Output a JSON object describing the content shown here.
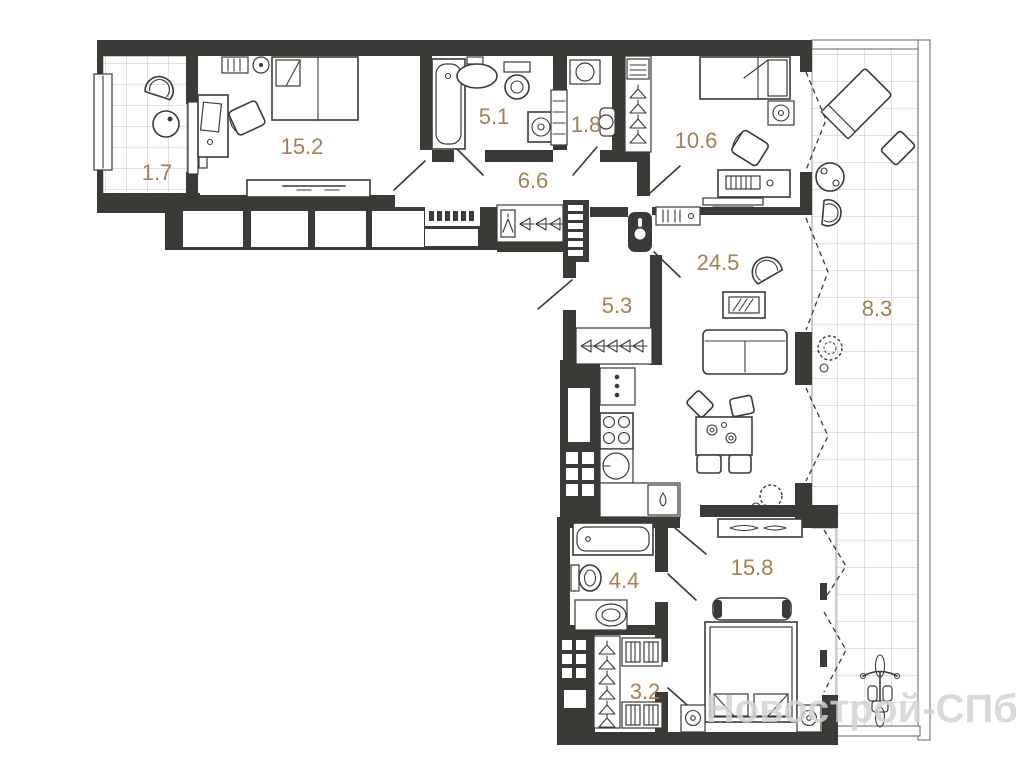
{
  "plan": {
    "type": "apartment-floor-plan",
    "colors": {
      "wall": "#3c3a37",
      "area_label": "#a5814d",
      "tile_grid": "#c3c3c3",
      "watermark": "#d3d3d3"
    },
    "watermark": {
      "text": "Новострой-СПб"
    },
    "rooms": [
      {
        "id": "balcony-top-left",
        "area": "1.7"
      },
      {
        "id": "bedroom-top",
        "area": "15.2"
      },
      {
        "id": "bathroom-top",
        "area": "5.1"
      },
      {
        "id": "wc",
        "area": "1.8"
      },
      {
        "id": "hallway-top",
        "area": "6.6"
      },
      {
        "id": "bedroom-right",
        "area": "10.6"
      },
      {
        "id": "living-room",
        "area": "24.5"
      },
      {
        "id": "entry-hall",
        "area": "5.3"
      },
      {
        "id": "balcony-right",
        "area": "8.3"
      },
      {
        "id": "bathroom-bottom",
        "area": "4.4"
      },
      {
        "id": "bedroom-bottom",
        "area": "15.8"
      },
      {
        "id": "wardrobe-room",
        "area": "3.2"
      }
    ]
  }
}
